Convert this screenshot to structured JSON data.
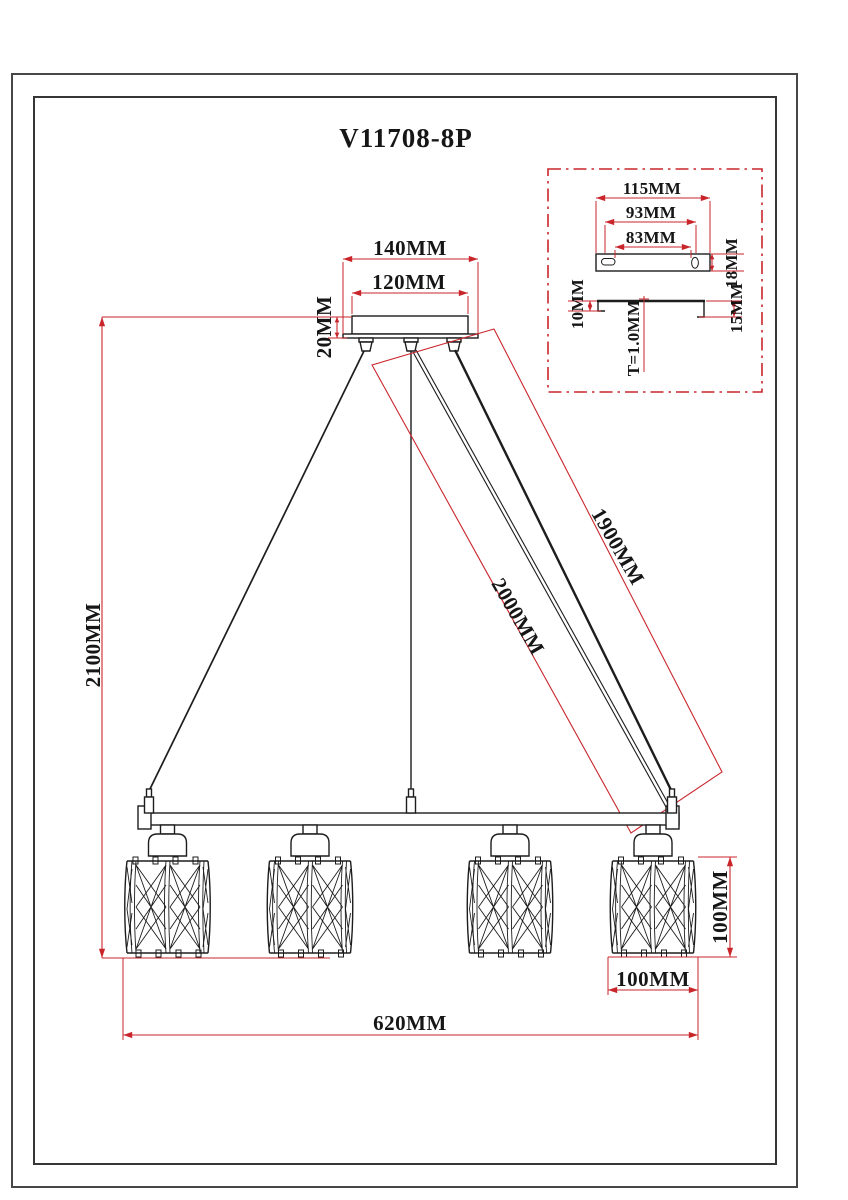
{
  "title": "V11708-8P",
  "colors": {
    "dimension_red": "#c9262c",
    "line_black": "#1d1d1d"
  },
  "dimensions": {
    "canopy_outer_width": "140MM",
    "canopy_inner_width": "120MM",
    "canopy_height": "20MM",
    "overall_drop": "2100MM",
    "cable_left": "2000MM",
    "cable_right": "1900MM",
    "frame_width": "620MM",
    "shade_height": "100MM",
    "shade_width": "100MM"
  },
  "mount_detail": {
    "plate_width": "115MM",
    "slot_span_outer": "93MM",
    "slot_span_inner": "83MM",
    "plate_depth": "18MM",
    "flange_left": "10MM",
    "flange_right": "15MM",
    "thickness": "T=1.0MM"
  }
}
